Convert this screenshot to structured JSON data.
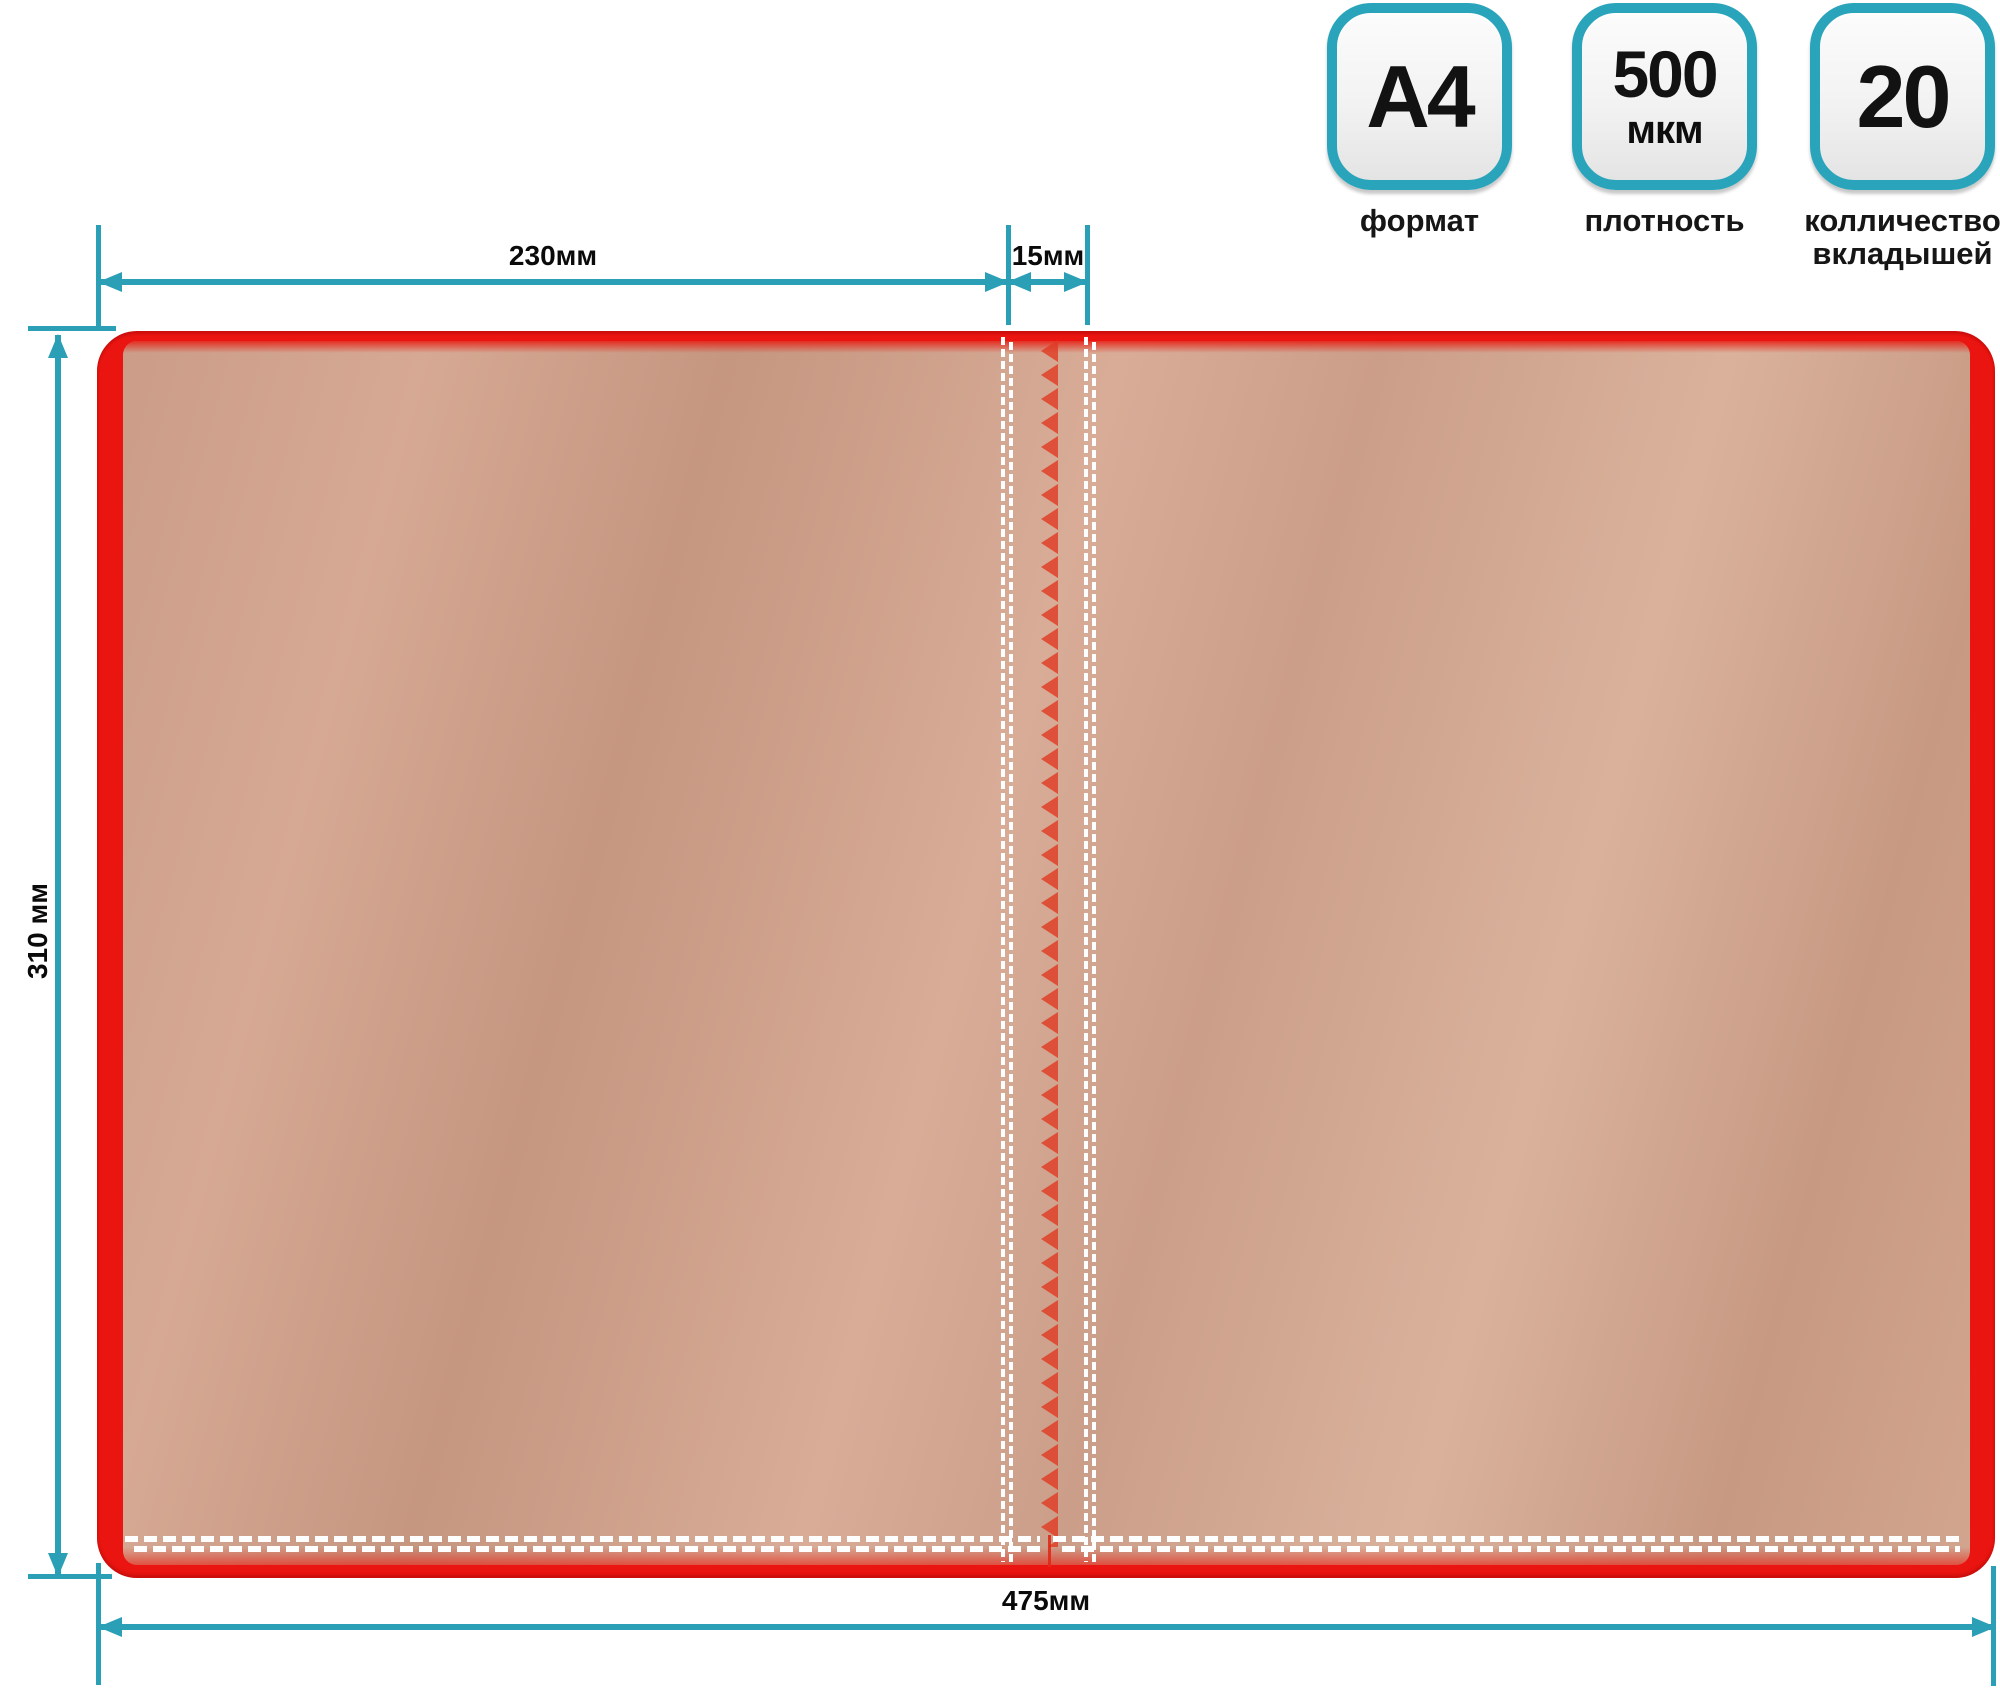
{
  "badges": [
    {
      "value": "A4",
      "label": "формат"
    },
    {
      "value": "500",
      "unit": "мкм",
      "label": "плотность"
    },
    {
      "value": "20",
      "label": "колличество вкладышей"
    }
  ],
  "dimensions": {
    "left_panel_width": "230мм",
    "spine_width": "15мм",
    "height": "310 мм",
    "total_width": "475мм"
  },
  "colors": {
    "accent_teal": "#2b9fb5",
    "folder_red": "#ea1410",
    "stitch_white": "#ffffff",
    "zigzag_red": "#e03a22",
    "copper_light": "#dab29c",
    "copper_dark": "#c5967f"
  }
}
